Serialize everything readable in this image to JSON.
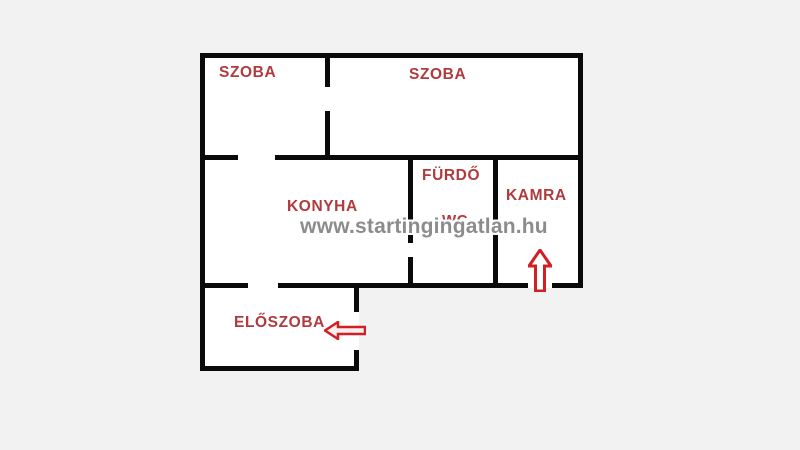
{
  "floorplan": {
    "watermark_text": "www.startingingatlan.hu",
    "rooms": [
      {
        "id": "szoba-left",
        "label": "SZOBA"
      },
      {
        "id": "szoba-right",
        "label": "SZOBA"
      },
      {
        "id": "konyha",
        "label": "KONYHA"
      },
      {
        "id": "furdo",
        "label": "FÜRDŐ"
      },
      {
        "id": "wc",
        "label": "WC"
      },
      {
        "id": "kamra",
        "label": "KAMRA"
      },
      {
        "id": "eloszoba",
        "label": "ELŐSZOBA"
      }
    ],
    "arrows": [
      {
        "name": "entrance-arrow-up",
        "direction": "up"
      },
      {
        "name": "entrance-arrow-left",
        "direction": "left"
      }
    ],
    "colors": {
      "background": "#f2f2f2",
      "floor": "#ffffff",
      "wall": "#0a0a0a",
      "room_label": "#b03a3c",
      "arrow": "#d21f26",
      "watermark": "#8c8c8c"
    }
  }
}
